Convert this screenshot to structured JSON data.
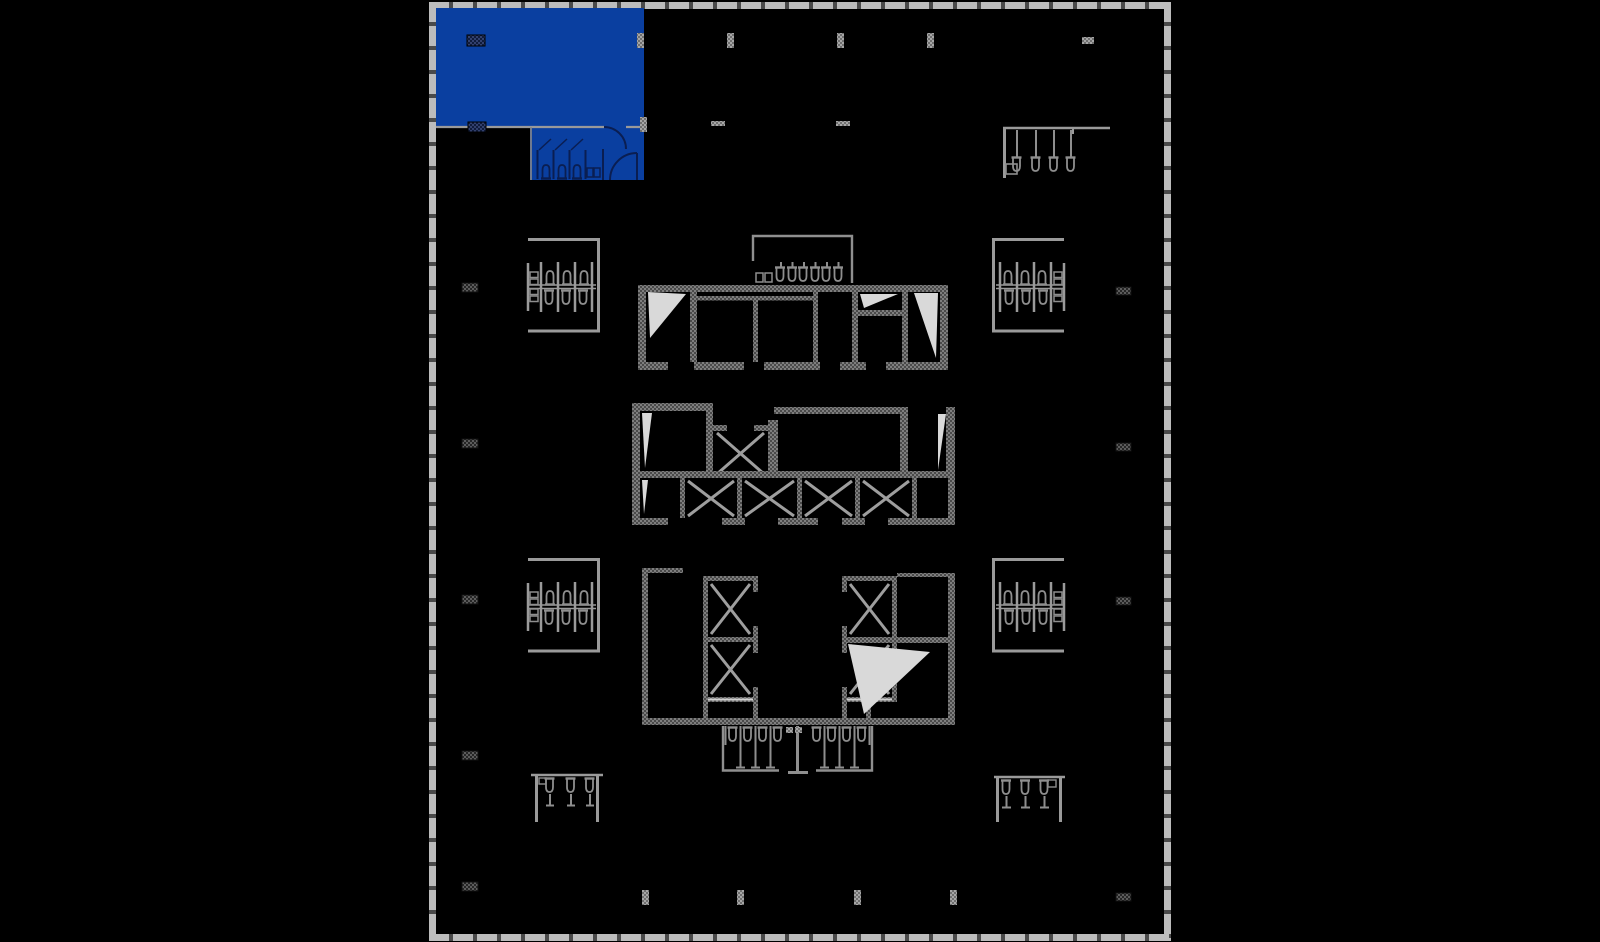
{
  "canvas": {
    "width": 1600,
    "height": 942,
    "background": "#000000"
  },
  "colors": {
    "background": "#000000",
    "suite_blue": "#0a3fa0",
    "suite_line_navy": "#0a1e52",
    "wall_gray_light": "#808080",
    "wall_gray_dark": "#4a4a4a",
    "fixture_gray": "#8e8e8e",
    "thin_line_gray": "#9a9a9a",
    "mullion_gray": "#bcbcbc",
    "mullion_gap": "#4a4a4a",
    "door_leaf_white": "#d9d9d9",
    "marker_dark": "#5c5c5c",
    "marker_light": "#a6a6a6",
    "marker_navy": "#32406e"
  },
  "plan": {
    "name": "building-floor-plate",
    "highlighted_suite": {
      "name": "highlighted-suite",
      "fill": "#0a3fa0"
    },
    "regions": [
      {
        "name": "building-perimeter-mullions"
      },
      {
        "name": "highlighted-suite"
      },
      {
        "name": "suite-restroom"
      },
      {
        "name": "upper-core-block"
      },
      {
        "name": "mid-core-elevator-bank"
      },
      {
        "name": "lower-core-elevator-bank"
      },
      {
        "name": "core-top-restroom"
      },
      {
        "name": "core-bottom-restroom"
      },
      {
        "name": "restroom-cluster-left-upper"
      },
      {
        "name": "restroom-cluster-left-middle"
      },
      {
        "name": "restroom-cluster-right-upper"
      },
      {
        "name": "restroom-cluster-right-middle"
      },
      {
        "name": "restroom-cluster-top-right"
      },
      {
        "name": "restroom-cluster-bottom-left"
      },
      {
        "name": "restroom-cluster-bottom-right"
      },
      {
        "name": "structural-column-grid"
      }
    ]
  }
}
